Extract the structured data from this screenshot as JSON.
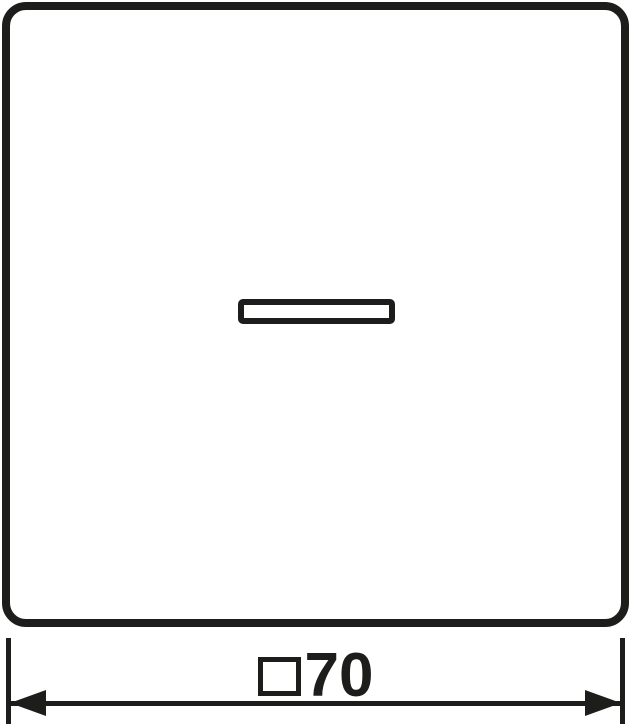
{
  "drawing": {
    "type": "dimensional-line-drawing",
    "subject": "square cover plate with indicator window",
    "colors": {
      "line": "#1d1d1b",
      "background": "#ffffff"
    },
    "dimension": {
      "symbol": "□",
      "symbol_icon": "square-outline-icon",
      "value": "70",
      "full_text": "□70"
    }
  }
}
